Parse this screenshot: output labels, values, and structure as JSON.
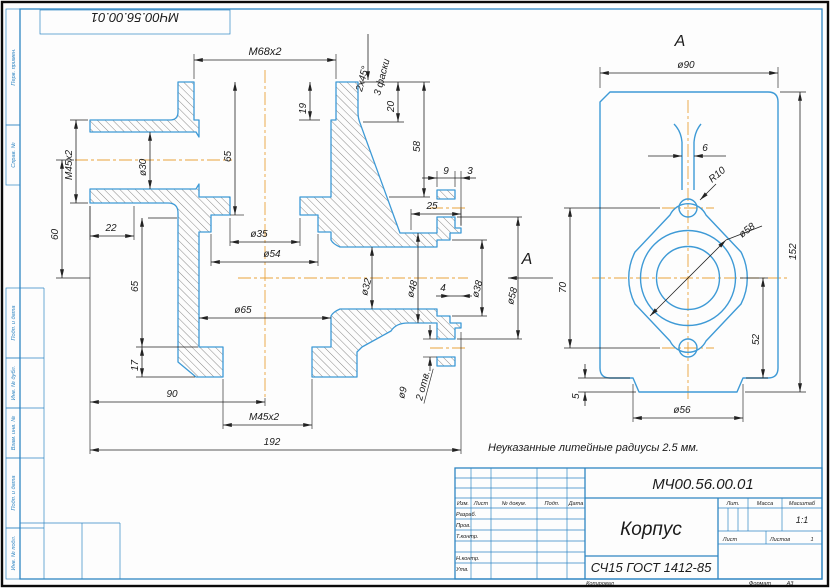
{
  "sheet": {
    "stamp": "МЧ00.56.00.01",
    "note": "Неуказанные литейные радиусы 2.5 мм.",
    "margins": [
      "Перв. примен.",
      "Справ. №",
      "Подп. и дата",
      "Инв. № дубл.",
      "Взам. инв. №",
      "Подп. и дата",
      "Инв. № подл."
    ]
  },
  "main_view": {
    "section_label": "А",
    "dims": {
      "m68": "M68x2",
      "chamfer": "2x45°",
      "chamfer_count": "3 фаски",
      "t19": "19",
      "t20": "20",
      "t58": "58",
      "t65_top": "65",
      "m45_left": "M45x2",
      "d30": "ø30",
      "t60": "60",
      "t22": "22",
      "d35": "ø35",
      "d54": "ø54",
      "d65": "ø65",
      "t65_low": "65",
      "t17": "17",
      "t90": "90",
      "m45_bottom": "M45x2",
      "t192": "192",
      "t25": "25",
      "t9": "9",
      "t3": "3",
      "d32": "ø32",
      "d48": "ø48",
      "d38": "ø38",
      "d58": "ø58",
      "t4": "4",
      "d9": "ø9",
      "holes": "2 отв."
    }
  },
  "view_a": {
    "label": "А",
    "d90": "ø90",
    "t6": "6",
    "r10": "R10",
    "t70": "70",
    "t152": "152",
    "t52": "52",
    "t5": "5",
    "d56": "ø56",
    "d58": "ø58"
  },
  "title_block": {
    "doc_number": "МЧ00.56.00.01",
    "part_name": "Корпус",
    "material": "СЧ15 ГОСТ 1412-85",
    "lit": "Лит.",
    "mass": "Масса",
    "scale_label": "Масштаб",
    "scale": "1:1",
    "sheet_label": "Лист",
    "sheets_label": "Листов",
    "sheets_value": "1",
    "izm": "Изм.",
    "list": "Лист",
    "docum": "№ докум.",
    "podp": "Подп.",
    "date": "Дата",
    "razrab": "Разраб.",
    "prov": "Пров.",
    "tkontr": "Т.контр.",
    "nkontr": "Н.контр.",
    "utv": "Утв.",
    "kopiroval": "Копировал",
    "format_label": "Формат",
    "format_value": "А3"
  }
}
